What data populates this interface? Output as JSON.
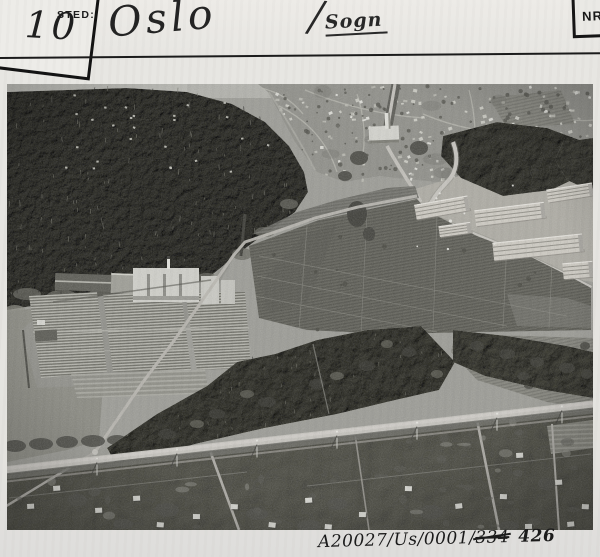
{
  "card": {
    "corner_number": "10",
    "sted_label": "STED:",
    "place_value": "Oslo",
    "district_slash": "/",
    "district_value": "Sogn",
    "nr_label": "NR.",
    "archive_ref": {
      "prefix": "A20027/Us/0001/",
      "struck": "334",
      "suffix": "426"
    }
  },
  "photo": {
    "alt": "Black-and-white aerial photograph of Sogn, Oslo: conifer forest and villa suburb at top, plant nursery with greenhouses and cold frames at left, striped allotment fields in the centre, apartment blocks under construction at right, and a main road with gardens and houses along the bottom.",
    "ink_color": "#1b1b1b",
    "card_color": "#e4e3df"
  }
}
